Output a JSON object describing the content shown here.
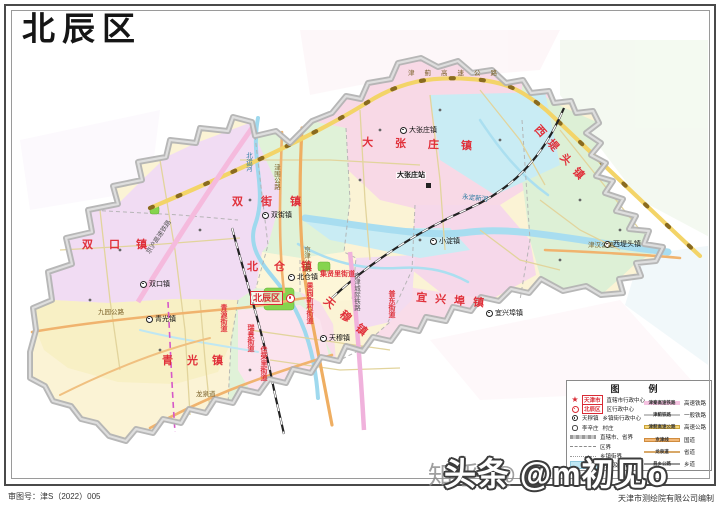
{
  "page": {
    "title": "北辰区",
    "review_no": "审图号：津S（2022）005",
    "publisher": "天津市测绘院有限公司编制"
  },
  "watermarks": {
    "zhihu": "知乎 @",
    "toutiao": "头条 @m初见o"
  },
  "legend": {
    "title": "图　例",
    "left": [
      {
        "icon": "capital-star-icon",
        "example": "天津市",
        "label": "直辖市行政中心"
      },
      {
        "icon": "district-center-icon",
        "example": "北辰区",
        "label": "区行政中心"
      },
      {
        "icon": "town-center-icon",
        "example": "天穆镇",
        "label": "乡镇街行政中心"
      },
      {
        "icon": "village-icon",
        "example": "李辛庄",
        "label": "村庄"
      },
      {
        "icon": "provincial-boundary-symbol",
        "example": "",
        "label": "直辖市、省界"
      },
      {
        "icon": "district-boundary-symbol",
        "example": "",
        "label": "区界"
      },
      {
        "icon": "town-boundary-symbol",
        "example": "",
        "label": "乡镇街界"
      },
      {
        "icon": "water-symbol",
        "example": "",
        "label": "河流及湖泊"
      }
    ],
    "right": [
      {
        "icon": "hsr-symbol",
        "example": "津秦高速铁路",
        "label": "高速铁路"
      },
      {
        "icon": "railway-symbol",
        "example": "津蓟铁路",
        "label": "一般铁路"
      },
      {
        "icon": "expressway-symbol",
        "example": "津蓟高速公路",
        "label": "高速公路"
      },
      {
        "icon": "national-road-symbol",
        "example": "京津线",
        "label": "国道"
      },
      {
        "icon": "provincial-road-symbol",
        "example": "龙泉道",
        "label": "省道"
      },
      {
        "icon": "county-road-symbol",
        "example": "县乡公路",
        "label": "乡道"
      }
    ]
  },
  "map": {
    "district_center": {
      "name": "北辰区"
    },
    "spread_labels": [
      "大张庄镇",
      "双街镇",
      "双口镇",
      "青光镇",
      "天穆镇",
      "北仓镇",
      "宜兴埠镇",
      "西堤头镇"
    ],
    "street_labels": [
      "果园新村街道",
      "集贤里街道",
      "普东街道",
      "瑞景街道",
      "佳荣里街道",
      "青源街道"
    ],
    "towns": [
      "北仓镇",
      "双口镇",
      "青光镇",
      "天穆镇",
      "双街镇",
      "大张庄镇",
      "小淀镇",
      "宜兴埠镇",
      "西堤头镇"
    ],
    "roads": [
      "津蓟高速公路",
      "京津公路",
      "津围公路",
      "九园公路",
      "龙泉道",
      "津汉公路"
    ],
    "railways": [
      "京沪高速铁路",
      "京津城际铁路"
    ],
    "station": "大张庄站",
    "rivers": [
      "永定新河",
      "北运河"
    ]
  },
  "colors": {
    "boundary_gray": "#b3b3b3",
    "expressway_yellow": "#f3d468",
    "main_road_orange": "#f0b36e",
    "hsr_pink": "#f5badd",
    "water_cyan": "#a8ddf0",
    "label_red": "#e0303a",
    "area_green": "#e0f2d8",
    "area_pink": "#f8dbe8",
    "area_lavender": "#f1dcf3",
    "area_yellow": "#fbf3d5"
  }
}
